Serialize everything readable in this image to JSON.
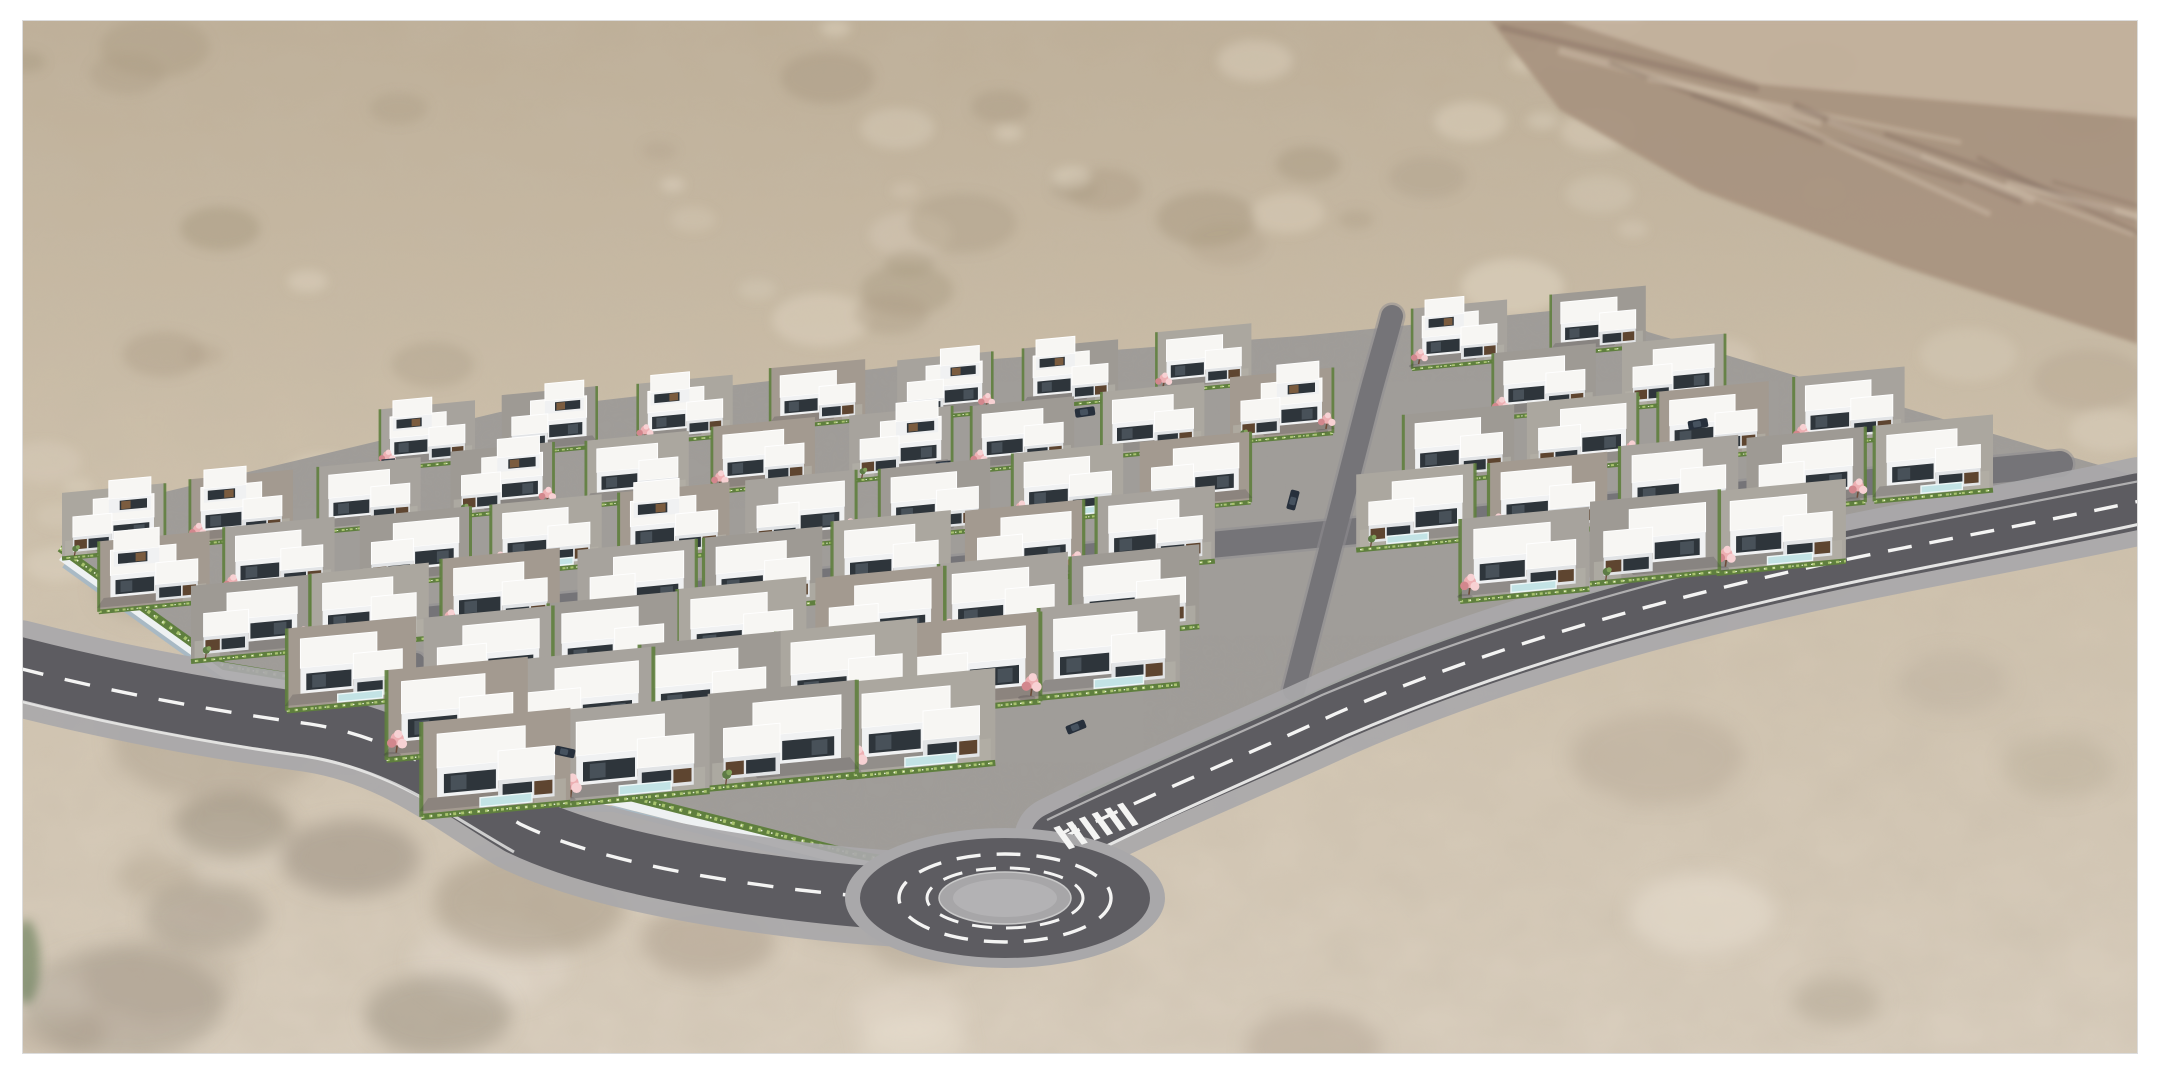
{
  "scene": {
    "type": "aerial-architectural-rendering",
    "subject": "Aerial 3D rendering of a modern white flat-roof villa development with pink blossom trees, terraced lots, perimeter roads and a roundabout, set in a tan desert landscape with a rocky ridge in the upper right, framed by a white border",
    "canvas": {
      "width": 2160,
      "height": 1080
    },
    "frame": {
      "color": "#ffffff",
      "top": 20,
      "right": 22,
      "bottom": 26,
      "left": 22,
      "edge": "#dcdcdc"
    },
    "palette": {
      "sand_top": "#bdae97",
      "sand_mid": "#cdc0ab",
      "sand_bot": "#d9cebe",
      "sand_dark": "#a79880",
      "sand_light": "#e6dcc9",
      "sand_deep": "#988b79",
      "rock_base": "#a8937f",
      "rock_dark": "#6f5a50",
      "rock_light": "#d9cbb6",
      "dev_ground": "#a09d99",
      "lot_tints": [
        "#a7a39d",
        "#9e9a94",
        "#aba79f",
        "#a39a90"
      ],
      "asphalt": "#5d5c61",
      "asphalt_internal": "#757478",
      "sidewalk": "#a9a8aa",
      "marking": "#f4f4f3",
      "island": "#a7a6a8",
      "island_inner": "#b3b2b4",
      "hedge": "#5f7f3e",
      "hedge_light": "#a9c46f",
      "hedge_dot": "#eef3dd",
      "tree_pink": "#edb0b3",
      "tree_pink_light": "#f7d1d3",
      "tree_pink_deep": "#d2878d",
      "tree_trunk": "#6d4c3a",
      "tree_green": "#5d7b45",
      "tree_green_light": "#82a25c",
      "roof": "#f7f6f3",
      "roof_edge": "#ffffff",
      "wall": "#f0f1f2",
      "wall_shade": "#e2e4e6",
      "band_dark": "#2e353b",
      "glass": "#4c565f",
      "wood": "#7b5c3f",
      "wood_dark": "#5e4530",
      "pool": "#c3e3e5",
      "pool_edge": "#edf7f7",
      "retaining_wall": "#eef1f2",
      "retaining_wall_shadow": "#a4b8c6",
      "shadow": "rgba(50,46,56,0.20)",
      "car_body": "#27303c",
      "car_glass": "#46525f"
    },
    "terrain": {
      "seed": 11,
      "regions": [
        {
          "x": 20,
          "y": 20,
          "w": 2120,
          "h": 320,
          "n": 46,
          "rmin": 12,
          "rmax": 55,
          "dark": "#a79880",
          "light": "#e4dac7",
          "blur": "b5",
          "op_min": 0.22,
          "op_max": 0.48
        },
        {
          "x": 20,
          "y": 330,
          "w": 420,
          "h": 250,
          "n": 12,
          "rmin": 15,
          "rmax": 45,
          "dark": "#a79880",
          "light": "#e4dac7",
          "blur": "b5",
          "op_min": 0.2,
          "op_max": 0.42
        },
        {
          "x": 1560,
          "y": 340,
          "w": 580,
          "h": 300,
          "n": 16,
          "rmin": 20,
          "rmax": 60,
          "dark": "#ab9c86",
          "light": "#e6dccb",
          "blur": "b5",
          "op_min": 0.2,
          "op_max": 0.42
        },
        {
          "x": 20,
          "y": 560,
          "w": 2120,
          "h": 500,
          "n": 34,
          "rmin": 35,
          "rmax": 95,
          "dark": "#b3a693",
          "light": "#e8dfd1",
          "blur": "b9",
          "op_min": 0.28,
          "op_max": 0.55
        },
        {
          "x": 60,
          "y": 640,
          "w": 900,
          "h": 420,
          "n": 10,
          "rmin": 50,
          "rmax": 110,
          "dark": "#9f917e",
          "light": "#8d8273",
          "blur": "b9",
          "op_min": 0.28,
          "op_max": 0.45
        }
      ],
      "rocky": {
        "poly": "1490,20 2138,20 2138,344 1900,266 1700,190 1560,110",
        "highlight_poly": "1560,20 2138,20 2138,118 1760,84",
        "streaks": 14
      }
    },
    "development": {
      "boundary": "110,505 500,412 900,366 1300,336 1600,306 1648,332 2136,476 2136,520 1312,700 1118,798 1016,850 948,866 846,860 614,800 480,798 302,686 228,674 62,556",
      "row_slope": -0.095,
      "rows": [
        {
          "x": 425,
          "y": 434.7,
          "n": 10,
          "gap": 130,
          "s": 0.72,
          "two": [
            0,
            1,
            2,
            4,
            5,
            7,
            8
          ]
        },
        {
          "x": 115,
          "y": 520.1,
          "n": 13,
          "gap": 130,
          "s": 0.78,
          "two": [
            0,
            1,
            3,
            6,
            9
          ]
        },
        {
          "x": 155,
          "y": 572.0,
          "n": 14,
          "gap": 130,
          "s": 0.84,
          "two": [
            0,
            4
          ]
        },
        {
          "x": 245,
          "y": 619.2,
          "n": 14,
          "gap": 130,
          "s": 0.9,
          "two": []
        },
        {
          "x": 355,
          "y": 664.6,
          "n": 12,
          "gap": 130,
          "s": 0.98,
          "two": []
        },
        {
          "x": 455,
          "y": 711.4,
          "n": 8,
          "gap": 130,
          "s": 1.07,
          "two": []
        },
        {
          "x": 500,
          "y": 763.9,
          "n": 4,
          "gap": 140,
          "s": 1.13,
          "two": []
        }
      ],
      "connector_gap": {
        "x_at_y318": 1390,
        "k": 0.26,
        "ymin": 300,
        "ymax": 700,
        "half": 70
      }
    },
    "roads": {
      "left_center": "M 18,668 C 120,694 220,712 310,724 C 400,738 450,782 520,824 C 590,858 700,878 800,890 C 860,897 910,900 940,900",
      "left_edge": "M 16,700 C 118,726 216,744 304,756 C 392,770 444,812 514,852",
      "ne_center": "M 1058,840 C 1150,794 1245,756 1335,714 C 1500,642 1695,589 1898,549 C 2000,529 2075,515 2140,501",
      "ne_edge_low": "M 1074,862 C 1166,816 1256,778 1346,736 C 1508,666 1700,612 1903,572 C 2003,552 2077,538 2140,524",
      "ne_edge_high": "M 1047,820 C 1140,775 1232,737 1322,695 C 1492,624 1688,569 1892,529 C 1994,509 2068,495 2140,481",
      "giveway": "M 1040,845 L 1076,826",
      "street_a": "M 350,627 C 900,575 1450,524 2060,464",
      "street_c": "M 1294,690 C 1320,590 1346,490 1364,418 C 1376,370 1386,340 1392,316",
      "street_branch": "M 306,700 C 344,686 378,674 416,662"
    },
    "walls": {
      "sw_hedge": "M 60,548 L 224,666 L 298,678 L 476,790 L 610,792 L 846,852 C 900,866 958,864 1014,842",
      "sw_wall": "M 62,556 L 226,674 L 300,686 L 478,798 L 612,800 L 846,860 C 900,874 960,872 1016,850",
      "sw_wall_shadow": "M 64,565 L 228,683 L 302,695 L 480,807 L 614,809 L 848,869 C 898,881 956,879 1012,859",
      "ne_hedge": "M 1080,799 C 1172,757 1264,719 1354,677 C 1522,609 1714,559 1914,523 C 2014,504 2084,491 2138,479",
      "ne_wall": "M 1080,807 C 1172,765 1264,727 1354,685 C 1522,617 1714,567 1914,531 C 2014,512 2084,499 2138,487",
      "ne_wall_shadow": "M 1080,812 C 1172,770 1264,732 1354,690 C 1522,622 1714,572 1914,536 C 2014,517 2084,504 2138,492"
    },
    "roundabout": {
      "cx": 1005,
      "cy": 898,
      "apron_rx": 160,
      "apron_ry": 70,
      "asphalt_rx": 145,
      "asphalt_ry": 60,
      "ring1_rx": 106,
      "ring1_ry": 44,
      "ring2_rx": 78,
      "ring2_ry": 30,
      "island_rx": 66,
      "island_ry": 26,
      "island_inner_rx": 52,
      "island_inner_ry": 19
    },
    "crosswalk": {
      "cx": 1096,
      "cy": 826,
      "ux": 0.94,
      "uy": -0.34,
      "vx": 0.34,
      "vy": 0.47,
      "n": 6,
      "step": 13.5,
      "len": 46,
      "w": 6.4
    },
    "street_cars": [
      [
        1293,
        500,
        -75
      ],
      [
        1085,
        412,
        -8
      ],
      [
        1076,
        727,
        -22
      ],
      [
        565,
        752,
        12
      ],
      [
        1698,
        424,
        -10
      ]
    ],
    "corner_shrub": {
      "x": 26,
      "y": 962,
      "rx": 14,
      "ry": 42,
      "fill": "#4c6b3f"
    }
  }
}
